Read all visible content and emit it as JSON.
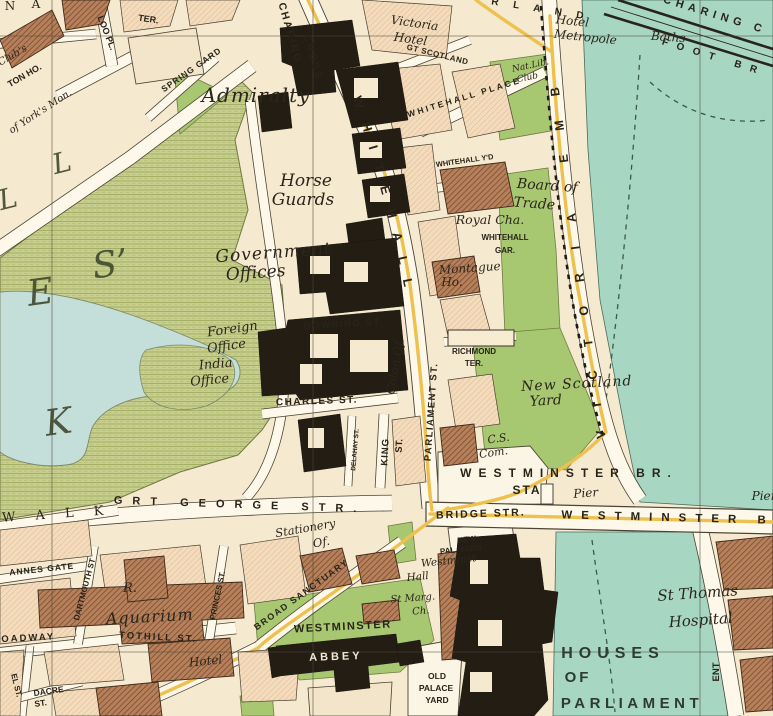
{
  "map": {
    "colors": {
      "land": "#f5e9cf",
      "water": "#a7d6c2",
      "lake": "#c4ded9",
      "park": "#c8cf8e",
      "garden_green": "#a8c771",
      "road_fill": "#fdf8ea",
      "main_route_yellow": "#eec14e",
      "public_building_black": "#231d14",
      "notable_building_brown": "#b5805a",
      "generic_building_pink": "#f3dcbc"
    },
    "labels": [
      {
        "t": "N",
        "x": 10,
        "y": 10,
        "s": 12,
        "c": "se"
      },
      {
        "t": "A",
        "x": 36,
        "y": 8,
        "s": 12,
        "c": "se"
      },
      {
        "t": "TER.",
        "x": 148,
        "y": 22,
        "s": 9,
        "r": 8,
        "c": "st"
      },
      {
        "t": "LOO PL.",
        "x": 104,
        "y": 34,
        "s": 9,
        "r": 68,
        "c": "st"
      },
      {
        "t": "TON HO.",
        "x": 26,
        "y": 78,
        "s": 9,
        "r": -30,
        "c": "st"
      },
      {
        "t": "Club's",
        "x": 14,
        "y": 58,
        "s": 10,
        "r": -30,
        "c": "pl"
      },
      {
        "t": "of York's Mon.",
        "x": 42,
        "y": 114,
        "s": 10,
        "r": -33,
        "c": "pl"
      },
      {
        "t": "SPRING GARD",
        "x": 193,
        "y": 72,
        "s": 8.5,
        "r": -35,
        "c": "st",
        "sp": 1
      },
      {
        "t": "Admiralty",
        "x": 256,
        "y": 102,
        "s": 20,
        "sp": 1,
        "c": "pl"
      },
      {
        "t": "CHARING",
        "x": 287,
        "y": 34,
        "s": 10.5,
        "r": 74,
        "c": "st",
        "sp": 2
      },
      {
        "t": "CROSS",
        "x": 310,
        "y": 58,
        "s": 10.5,
        "r": 74,
        "c": "st",
        "sp": 2
      },
      {
        "t": "Victoria",
        "x": 414,
        "y": 27,
        "s": 12,
        "r": 8,
        "c": "pl"
      },
      {
        "t": "Hotel",
        "x": 410,
        "y": 43,
        "s": 12,
        "r": 8,
        "c": "pl"
      },
      {
        "t": "GT SCOTLAND",
        "x": 437,
        "y": 57,
        "s": 8,
        "r": 14,
        "c": "st",
        "sp": 0.5
      },
      {
        "t": "R L A N D",
        "x": 540,
        "y": 12,
        "s": 10,
        "r": 9,
        "c": "st",
        "sp": 6
      },
      {
        "t": "Hotel",
        "x": 572,
        "y": 25,
        "s": 12,
        "r": 6,
        "c": "pl"
      },
      {
        "t": "Metropole",
        "x": 585,
        "y": 41,
        "s": 12,
        "r": 6,
        "c": "pl"
      },
      {
        "t": "Baths",
        "x": 668,
        "y": 41,
        "s": 12,
        "r": 4,
        "c": "pl"
      },
      {
        "t": "CHARING C",
        "x": 714,
        "y": 18,
        "s": 11,
        "r": 17,
        "c": "st",
        "sp": 5
      },
      {
        "t": "FOOT BR",
        "x": 713,
        "y": 60,
        "s": 10,
        "r": 17,
        "c": "st",
        "sp": 9
      },
      {
        "t": "WHITEHALL PLACE",
        "x": 465,
        "y": 100,
        "s": 8.5,
        "r": -17,
        "c": "st",
        "sp": 2.5
      },
      {
        "t": "Nat.Lib.",
        "x": 531,
        "y": 68,
        "s": 9,
        "r": -12,
        "c": "pl"
      },
      {
        "t": "Club",
        "x": 528,
        "y": 80,
        "s": 9,
        "r": -12,
        "c": "pl"
      },
      {
        "t": "WHITEHALL Y'D",
        "x": 465,
        "y": 163,
        "s": 7.5,
        "r": -8,
        "c": "st"
      },
      {
        "t": "Horse",
        "x": 306,
        "y": 186,
        "s": 17,
        "c": "pl"
      },
      {
        "t": "Guards",
        "x": 303,
        "y": 205,
        "s": 17,
        "c": "pl"
      },
      {
        "t": "Board of",
        "x": 547,
        "y": 190,
        "s": 14,
        "r": 4,
        "c": "pl"
      },
      {
        "t": "Trade",
        "x": 534,
        "y": 208,
        "s": 14,
        "r": 4,
        "c": "pl"
      },
      {
        "t": "Royal Cha.",
        "x": 490,
        "y": 224,
        "s": 12.5,
        "c": "pl"
      },
      {
        "t": "WHITEHALL",
        "x": 505,
        "y": 240,
        "s": 8,
        "c": "st"
      },
      {
        "t": "GAR.",
        "x": 505,
        "y": 253,
        "s": 8,
        "c": "st"
      },
      {
        "t": "Montague",
        "x": 470,
        "y": 272,
        "s": 12,
        "r": -4,
        "c": "pl"
      },
      {
        "t": "Ho.",
        "x": 452,
        "y": 286,
        "s": 12,
        "c": "pl"
      },
      {
        "t": "Government",
        "x": 274,
        "y": 258,
        "s": 17,
        "r": -4,
        "c": "pl",
        "sp": 1
      },
      {
        "t": "Offices",
        "x": 256,
        "y": 278,
        "s": 17,
        "r": -4,
        "c": "pl"
      },
      {
        "t": "Foreign",
        "x": 233,
        "y": 333,
        "s": 13,
        "r": -8,
        "c": "pl"
      },
      {
        "t": "Office",
        "x": 227,
        "y": 350,
        "s": 13,
        "r": -8,
        "c": "pl"
      },
      {
        "t": "India",
        "x": 216,
        "y": 368,
        "s": 13,
        "r": -5,
        "c": "pl"
      },
      {
        "t": "Office",
        "x": 210,
        "y": 384,
        "s": 13,
        "r": -5,
        "c": "pl"
      },
      {
        "t": "DOWNING ST.",
        "x": 344,
        "y": 327,
        "s": 9.5,
        "r": -3,
        "c": "st",
        "sp": 1.5
      },
      {
        "t": "Colon.Of.",
        "x": 399,
        "y": 367,
        "s": 12,
        "r": -80,
        "c": "pl"
      },
      {
        "t": "CHARLES ST.",
        "x": 317,
        "y": 404,
        "s": 10,
        "r": -2,
        "c": "st",
        "sp": 1.5
      },
      {
        "t": "RICHMOND",
        "x": 474,
        "y": 354,
        "s": 8,
        "c": "st"
      },
      {
        "t": "TER.",
        "x": 474,
        "y": 366,
        "s": 8,
        "c": "st"
      },
      {
        "t": "New Scotland",
        "x": 577,
        "y": 388,
        "s": 14,
        "r": -3,
        "c": "pl",
        "sp": 1
      },
      {
        "t": "Yard",
        "x": 546,
        "y": 405,
        "s": 14,
        "r": -3,
        "c": "pl"
      },
      {
        "t": "DELAHAY ST.",
        "x": 357,
        "y": 450,
        "s": 6.5,
        "r": -85,
        "c": "st"
      },
      {
        "t": "KING",
        "x": 388,
        "y": 452,
        "s": 9.5,
        "r": -87,
        "c": "st",
        "sp": 1
      },
      {
        "t": "ST.",
        "x": 402,
        "y": 446,
        "s": 9.5,
        "r": -87,
        "c": "st"
      },
      {
        "t": "PARLIAMENT ST.",
        "x": 434,
        "y": 412,
        "s": 9.5,
        "r": -86,
        "c": "st",
        "sp": 1.5
      },
      {
        "t": "C.S.",
        "x": 499,
        "y": 442,
        "s": 11,
        "r": -8,
        "c": "pl"
      },
      {
        "t": "Com.",
        "x": 494,
        "y": 456,
        "s": 11,
        "r": -8,
        "c": "pl"
      },
      {
        "t": "WESTMINSTER BR.",
        "x": 569,
        "y": 477,
        "s": 12,
        "c": "st",
        "sp": 7
      },
      {
        "t": "STA",
        "x": 527,
        "y": 494,
        "s": 12,
        "c": "st",
        "sp": 2
      },
      {
        "t": "Pier",
        "x": 586,
        "y": 497,
        "s": 12,
        "r": -4,
        "c": "pl"
      },
      {
        "t": "Pier",
        "x": 764,
        "y": 500,
        "s": 12,
        "c": "pl"
      },
      {
        "t": "BRIDGE STR.",
        "x": 481,
        "y": 517,
        "s": 10.5,
        "r": -2,
        "c": "st",
        "sp": 2
      },
      {
        "t": "WESTMINSTER B",
        "x": 668,
        "y": 521,
        "s": 11.5,
        "r": 1.5,
        "c": "st",
        "sp": 9
      },
      {
        "t": "GRT GEORGE STR.",
        "x": 240,
        "y": 508,
        "s": 11,
        "r": 2,
        "c": "st",
        "sp": 10
      },
      {
        "t": "W A L K",
        "x": 57,
        "y": 518,
        "s": 13,
        "r": -4,
        "c": "se",
        "sp": 8
      },
      {
        "t": "K",
        "x": 60,
        "y": 434,
        "s": 36,
        "r": -8,
        "c": "big"
      },
      {
        "t": "E",
        "x": 42,
        "y": 304,
        "s": 36,
        "r": -8,
        "c": "big"
      },
      {
        "t": "S’",
        "x": 112,
        "y": 276,
        "s": 36,
        "r": -8,
        "c": "big"
      },
      {
        "t": "L",
        "x": 64,
        "y": 172,
        "s": 28,
        "r": -14,
        "c": "big"
      },
      {
        "t": "L",
        "x": 10,
        "y": 208,
        "s": 28,
        "r": -14,
        "c": "big"
      },
      {
        "t": "Stationery",
        "x": 306,
        "y": 532,
        "s": 11.5,
        "r": -10,
        "c": "pl"
      },
      {
        "t": "Of.",
        "x": 322,
        "y": 546,
        "s": 11.5,
        "r": -10,
        "c": "pl"
      },
      {
        "t": "BROAD SANCTUARY",
        "x": 303,
        "y": 597,
        "s": 9,
        "r": -36,
        "c": "st",
        "sp": 1.5
      },
      {
        "t": "ANNES GATE",
        "x": 42,
        "y": 572,
        "s": 8.5,
        "r": -6,
        "c": "st",
        "sp": 1
      },
      {
        "t": "DARTMOUTH ST",
        "x": 87,
        "y": 590,
        "s": 8,
        "r": -75,
        "c": "st"
      },
      {
        "t": "PRINCES ST.",
        "x": 220,
        "y": 596,
        "s": 8,
        "r": -78,
        "c": "st"
      },
      {
        "t": "R.",
        "x": 130,
        "y": 592,
        "s": 13,
        "c": "pl"
      },
      {
        "t": "Aquarium",
        "x": 150,
        "y": 622,
        "s": 16,
        "r": -3,
        "c": "pl",
        "sp": 1
      },
      {
        "t": "ROADWAY",
        "x": 24,
        "y": 641,
        "s": 9.5,
        "r": -3,
        "c": "st",
        "sp": 2
      },
      {
        "t": "TOTHILL ST.",
        "x": 158,
        "y": 640,
        "s": 9.5,
        "r": 3,
        "c": "st",
        "sp": 2
      },
      {
        "t": "Hotel",
        "x": 206,
        "y": 665,
        "s": 12,
        "r": -6,
        "c": "pl"
      },
      {
        "t": "DACRE",
        "x": 49,
        "y": 694,
        "s": 8.5,
        "r": -8,
        "c": "st"
      },
      {
        "t": "ST.",
        "x": 41,
        "y": 706,
        "s": 8.5,
        "r": -8,
        "c": "st"
      },
      {
        "t": "EL ST.",
        "x": 14,
        "y": 686,
        "s": 8,
        "r": 76,
        "c": "st"
      },
      {
        "t": "WESTMINSTER",
        "x": 343,
        "y": 630,
        "s": 11,
        "r": -3,
        "c": "st",
        "sp": 1.5,
        "f": "#2c3418"
      },
      {
        "t": "ABBEY",
        "x": 336,
        "y": 660,
        "s": 11,
        "r": -2,
        "c": "wh",
        "sp": 3
      },
      {
        "t": "NEW",
        "x": 467,
        "y": 542,
        "s": 8,
        "r": -6,
        "c": "st"
      },
      {
        "t": "PAL. YARD",
        "x": 461,
        "y": 552,
        "s": 8,
        "r": -6,
        "c": "st"
      },
      {
        "t": "Westminst",
        "x": 449,
        "y": 564,
        "s": 10.5,
        "r": -6,
        "c": "pl"
      },
      {
        "t": "Hall",
        "x": 418,
        "y": 580,
        "s": 10.5,
        "r": -6,
        "c": "pl"
      },
      {
        "t": "St Marg.",
        "x": 413,
        "y": 601,
        "s": 10,
        "r": -4,
        "c": "pl"
      },
      {
        "t": "Ch.",
        "x": 421,
        "y": 614,
        "s": 10,
        "r": -4,
        "c": "pl"
      },
      {
        "t": "OLD",
        "x": 437,
        "y": 679,
        "s": 8.5,
        "c": "st"
      },
      {
        "t": "PALACE",
        "x": 436,
        "y": 691,
        "s": 8.5,
        "c": "st"
      },
      {
        "t": "YARD",
        "x": 437,
        "y": 703,
        "s": 8.5,
        "c": "st"
      },
      {
        "t": "HOUSES",
        "x": 613,
        "y": 658,
        "s": 16,
        "c": "wa",
        "sp": 6
      },
      {
        "t": "OF",
        "x": 578,
        "y": 682,
        "s": 15,
        "c": "wa",
        "sp": 3
      },
      {
        "t": "PARLIAMENT",
        "x": 632,
        "y": 708,
        "s": 15,
        "c": "wa",
        "sp": 4.5
      },
      {
        "t": "St Thomas",
        "x": 698,
        "y": 598,
        "s": 15,
        "r": -4,
        "c": "pl",
        "f": "#2a413a"
      },
      {
        "t": "Hospital",
        "x": 701,
        "y": 625,
        "s": 15,
        "r": -4,
        "c": "pl",
        "f": "#2a413a"
      },
      {
        "t": "ENT",
        "x": 719,
        "y": 672,
        "s": 9.5,
        "r": -90,
        "c": "st"
      }
    ],
    "path_labels": [
      {
        "t": "WHITEHALL",
        "path": "p-whitehall",
        "s": 13,
        "sp": 15,
        "c": "st",
        "o": 2
      },
      {
        "t": "VICTORIA EMB",
        "path": "p-vicemb",
        "s": 12.5,
        "sp": 24,
        "c": "st",
        "o": 4
      }
    ]
  }
}
